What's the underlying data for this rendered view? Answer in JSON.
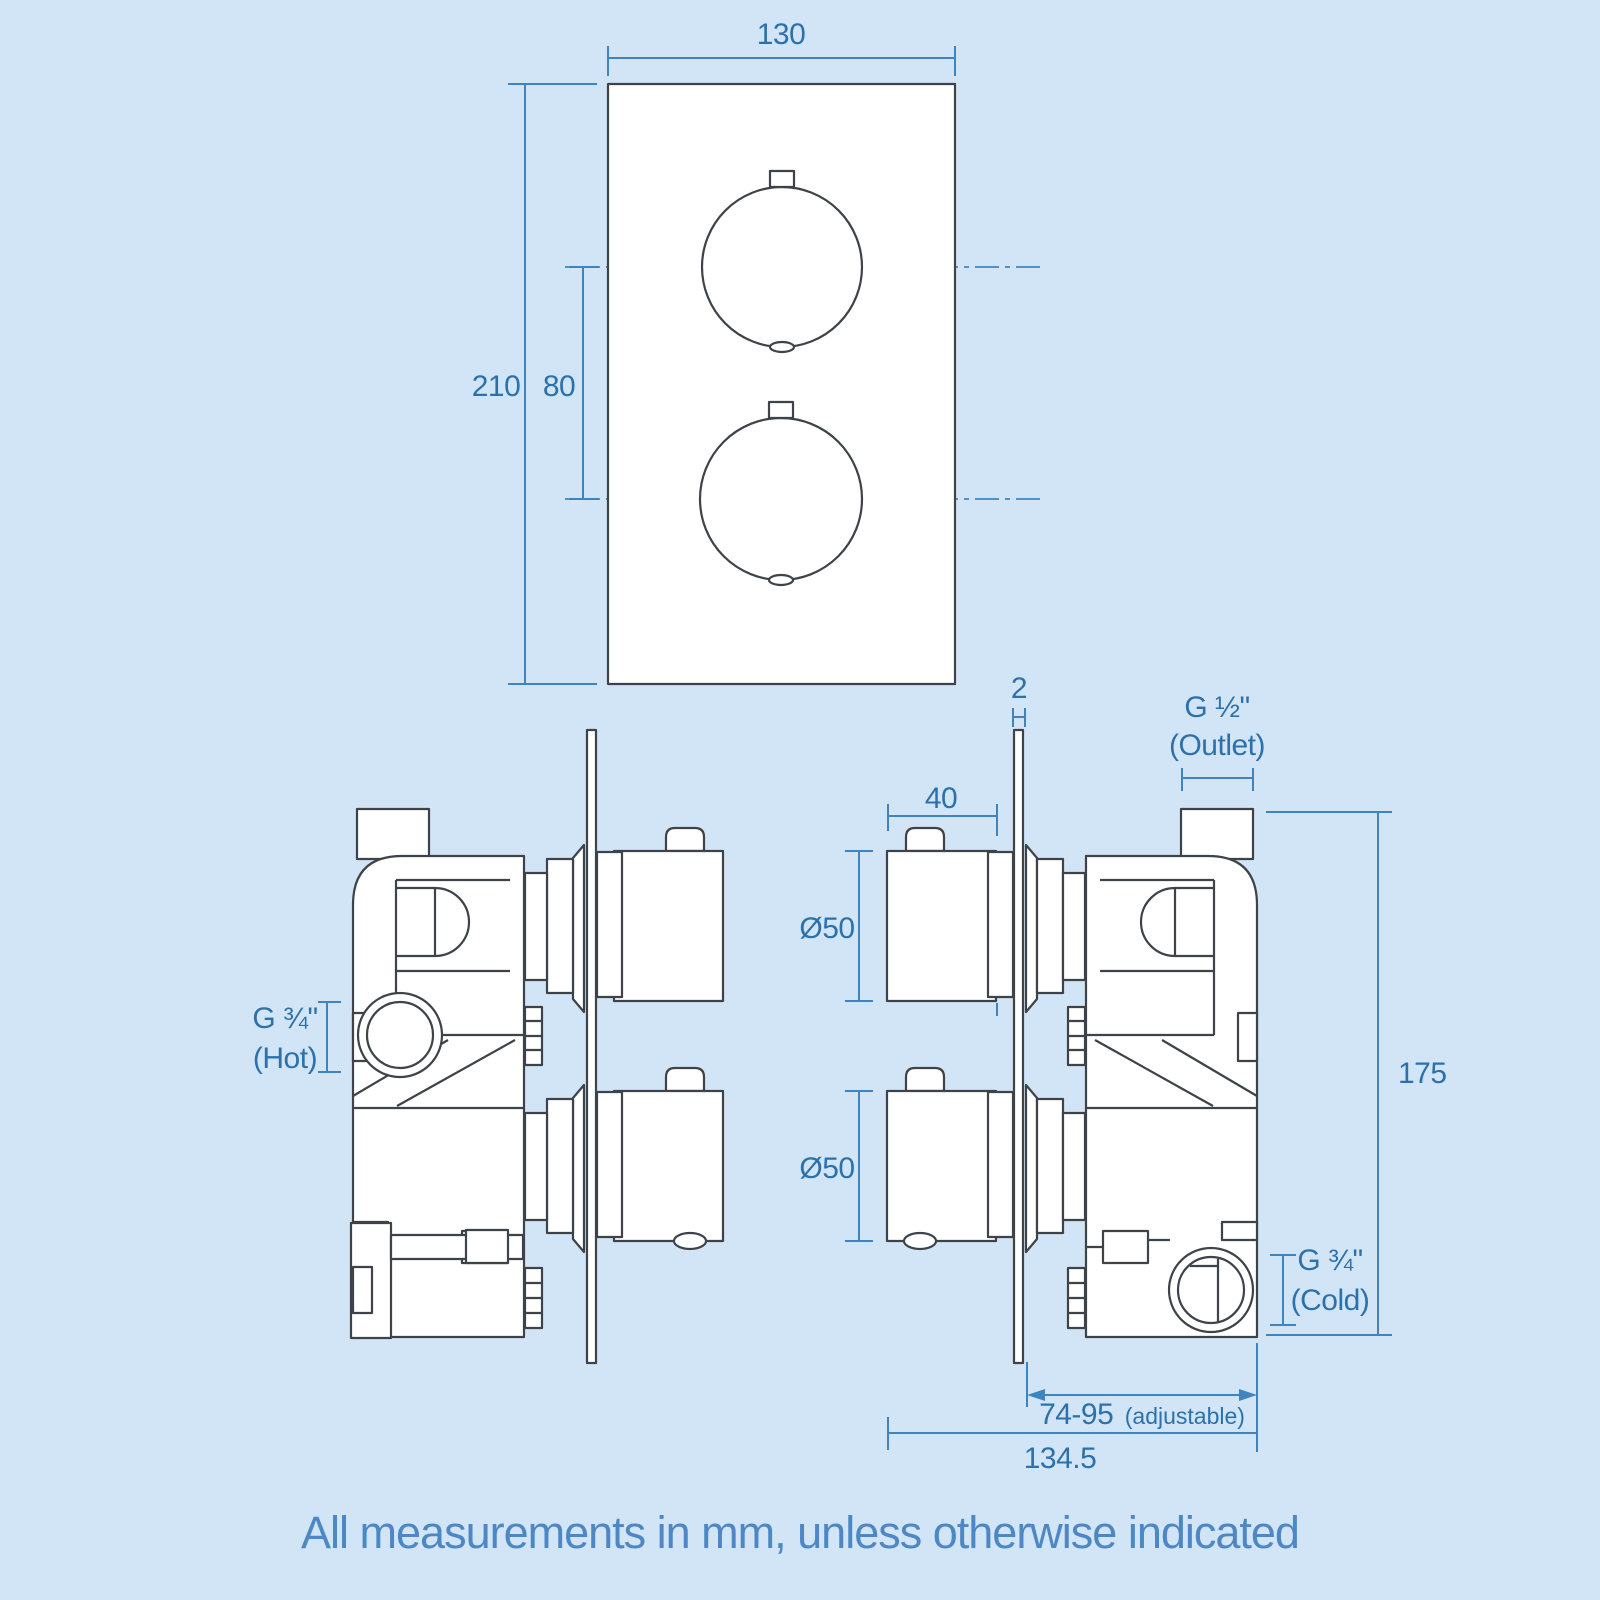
{
  "colors": {
    "bg": "#d2e5f6",
    "line": "#3d4349",
    "dim": "#3e85c0",
    "dimtext": "#2c71ab",
    "caption": "#4d87c4"
  },
  "front_view": {
    "width_label": "130",
    "height_label": "210",
    "spacing_label": "80"
  },
  "side_view": {
    "plate_thickness_label": "2",
    "outlet_label": "G ½\"",
    "outlet_sub": "(Outlet)",
    "knob_width_label": "40",
    "knob_dia_top_label": "Ø50",
    "knob_dia_bottom_label": "Ø50",
    "hot_label": "G ¾\"",
    "hot_sub": "(Hot)",
    "height_label": "175",
    "cold_label": "G ¾\"",
    "cold_sub": "(Cold)",
    "adjustable_label": "74-95",
    "adjustable_sub": "(adjustable)",
    "depth_label": "134.5"
  },
  "footer": {
    "note": "All measurements in mm, unless otherwise indicated"
  }
}
